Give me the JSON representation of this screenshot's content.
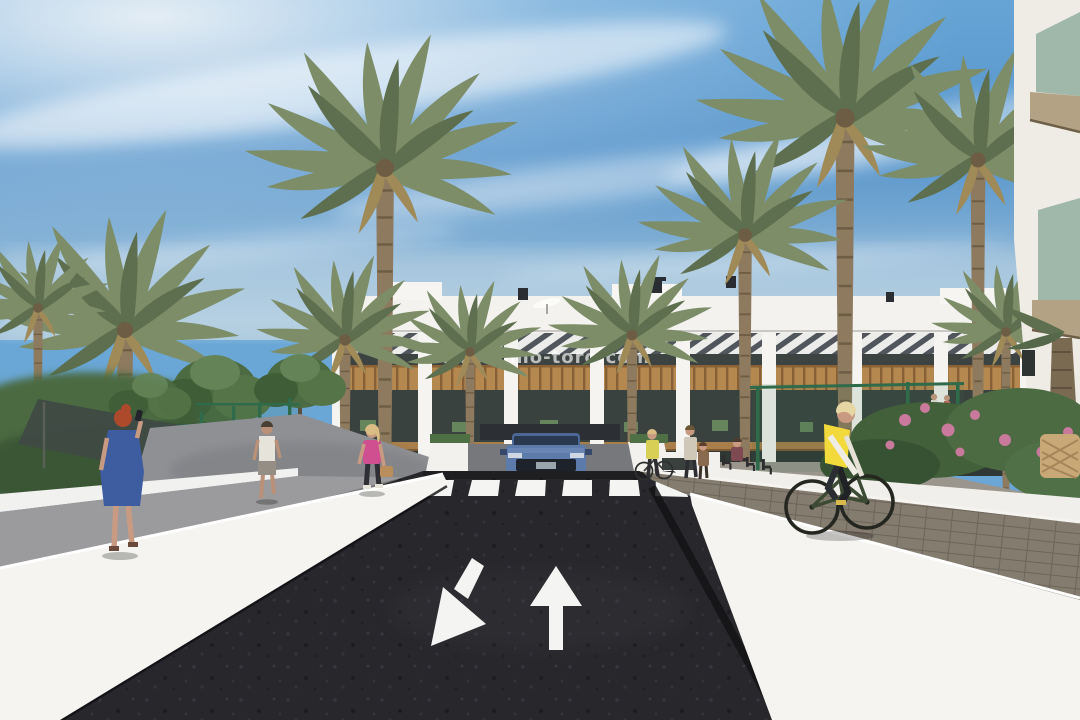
{
  "watermark": {
    "text": "www.immo-toro.com"
  },
  "scene": {
    "type": "architectural-exterior-render",
    "objects": [
      "white apartment complex with striped pergola awnings and wood trim",
      "date palm trees",
      "leafy garden trees and bushes with pink flowers",
      "asphalt access road with painted lane arrows",
      "zebra crosswalk",
      "underground garage ramp with blue SUV",
      "white boundary walls",
      "gray pedestrian sidewalk",
      "paved cycle path",
      "green mesh sports fence",
      "dark shade sail",
      "woman in blue dress on phone",
      "man walking",
      "woman in pink with handbag",
      "woman standing with bicycle",
      "adult with child",
      "seated person at terrace",
      "terrace chairs",
      "cyclist in yellow vest",
      "balcony residents",
      "foreground glass balconies",
      "wicker chair"
    ],
    "road_markings": {
      "left_lane": "arrow-down-left",
      "right_lane": "arrow-up"
    }
  },
  "colors": {
    "sky_light": "#eaf1f6",
    "sky_mid": "#66a4d6",
    "sky_deep": "#5795cb",
    "building_white": "#f3f2ee",
    "awning_stripe": "#50565c",
    "wood_trim": "#b5884f",
    "glass_dark": "#39423e",
    "glass_ground": "#2f3835",
    "wall_white": "#f5f4f1",
    "sidewalk_gray": "#9b9b9d",
    "slope_gray": "#8f9094",
    "asphalt": "#28282c",
    "road_marking": "#f4f4f2",
    "paver_tan": "#857c70",
    "palm_frond": "#7c8d68",
    "palm_trunk": "#8d7a5f",
    "tree_green": "#4c6b42",
    "fence_green": "#2f6a4a",
    "canopy_dark": "#3f4a44",
    "flower_pink": "#c97a9c",
    "car_blue": "#5c7bab",
    "dress_blue": "#3e5ca0",
    "hair_red": "#ad4a2c",
    "vest_yellow": "#f2d93c",
    "top_pink": "#cf4f90",
    "skin": "#c89a82",
    "fg_glass_green": "#9ab5a5",
    "fg_slab_tan": "#b3a284",
    "rattan_tan": "#c9a878"
  }
}
